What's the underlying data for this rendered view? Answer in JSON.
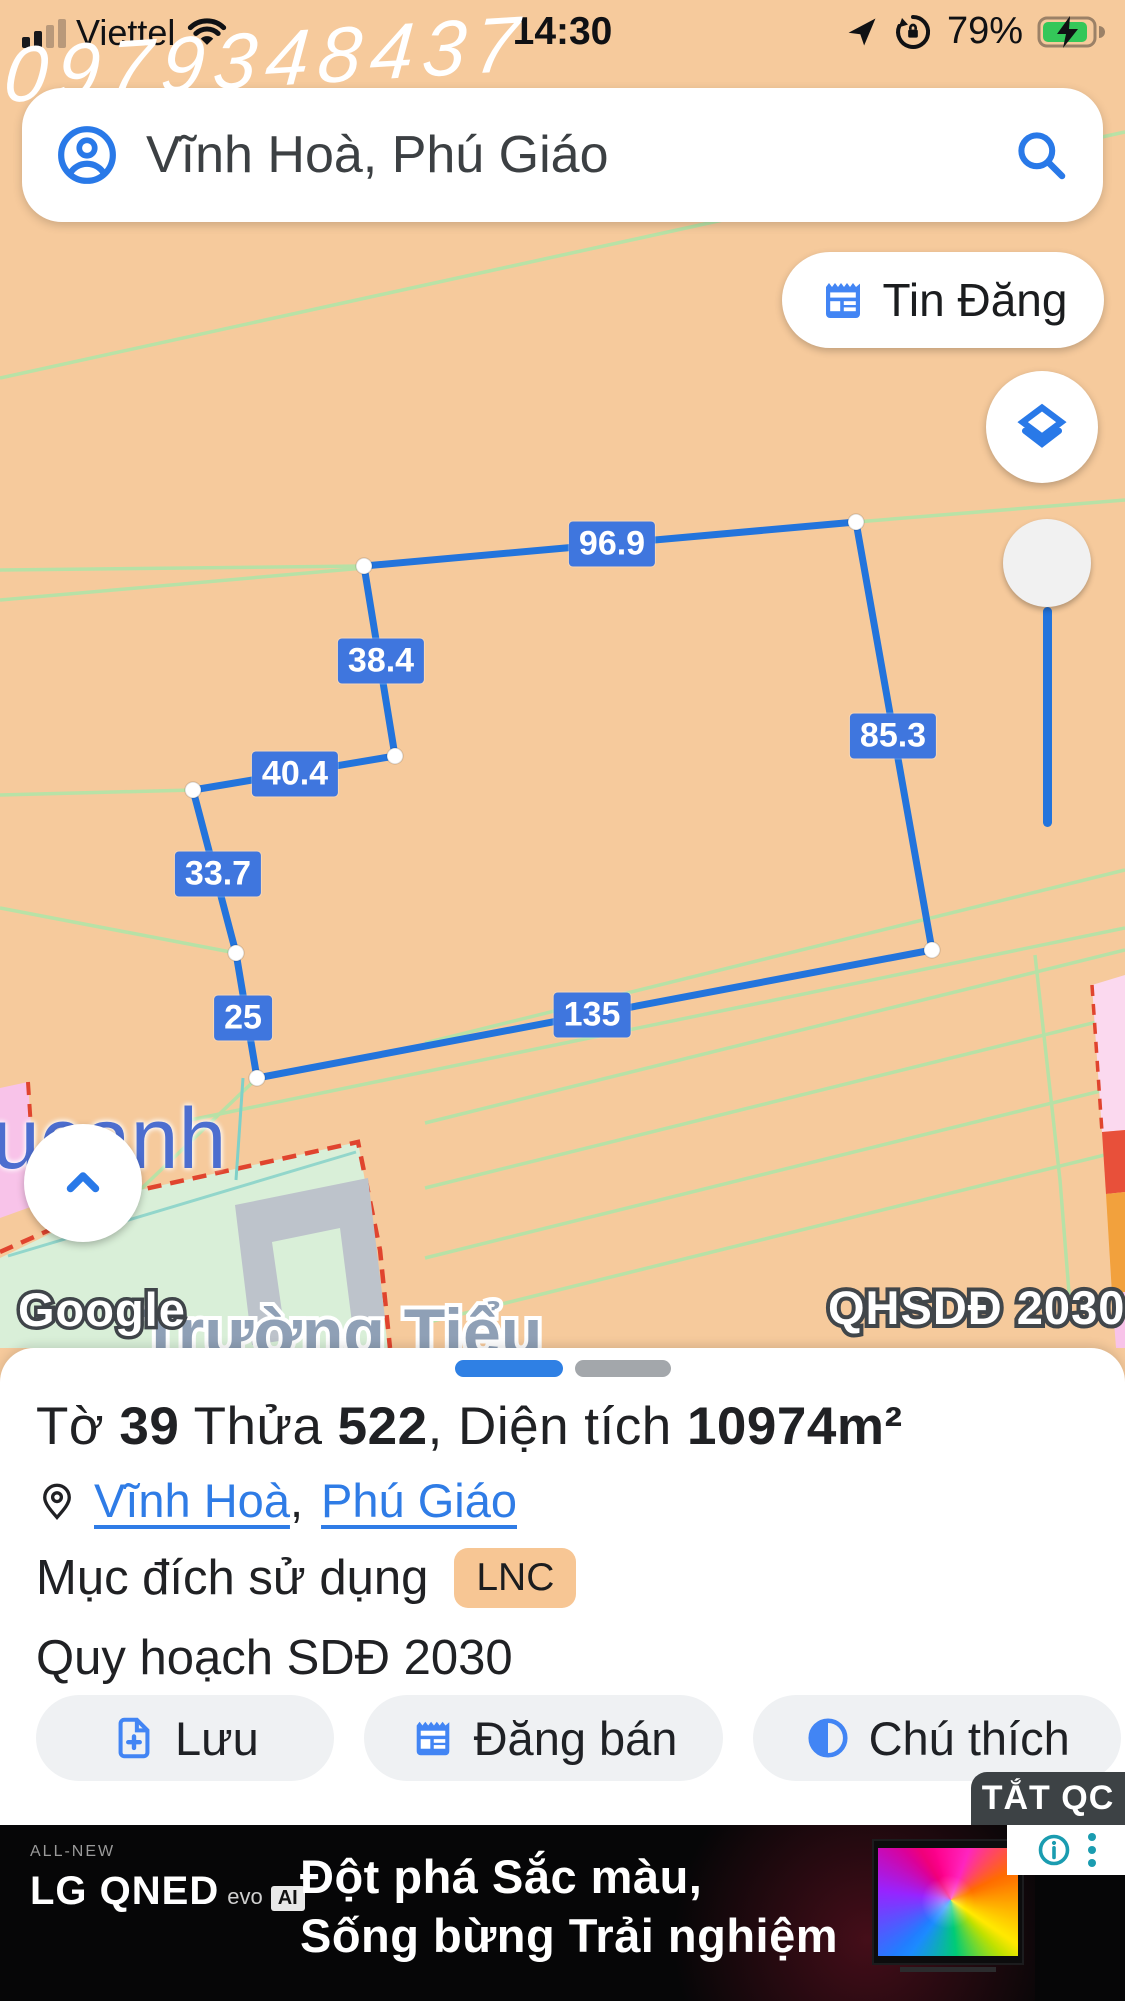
{
  "status_bar": {
    "carrier": "Viettel",
    "time": "14:30",
    "battery_percent": "79%"
  },
  "watermark": "0979348437",
  "search": {
    "value": "Vĩnh Hoà, Phú Giáo"
  },
  "map": {
    "listings_button": "Tin Đăng",
    "plan_overlay_label": "QHSDĐ 2030",
    "place_labels": {
      "partial_place": "ucanh",
      "school": "Trường Tiểu",
      "attribution": "Google"
    },
    "measurements": [
      {
        "value": "96.9"
      },
      {
        "value": "38.4"
      },
      {
        "value": "85.3"
      },
      {
        "value": "40.4"
      },
      {
        "value": "33.7"
      },
      {
        "value": "25"
      },
      {
        "value": "135"
      }
    ],
    "colors": {
      "parcel_line": "#2374dc",
      "label_bg": "#3f76de",
      "background": "#f6ca9c"
    }
  },
  "sheet": {
    "title": {
      "t1": "Tờ",
      "no1": "39",
      "t2": "Thửa",
      "no2": "522",
      "t3": ", Diện tích",
      "area": "10974m²"
    },
    "links": {
      "ward": "Vĩnh Hoà",
      "sep": ",",
      "district": "Phú Giáo"
    },
    "land_use": {
      "label": "Mục đích sử dụng",
      "badge": "LNC"
    },
    "planning": "Quy hoạch SDĐ 2030",
    "buttons": {
      "save": "Lưu",
      "sell": "Đăng bán",
      "legend": "Chú thích"
    }
  },
  "ad": {
    "dismiss": "TẮT QC",
    "all_new": "ALL-NEW",
    "brand": "LG QNED",
    "evo": "evo",
    "ai": "AI",
    "line1": "Đột phá Sắc màu,",
    "line2": "Sống bừng Trải nghiệm"
  }
}
